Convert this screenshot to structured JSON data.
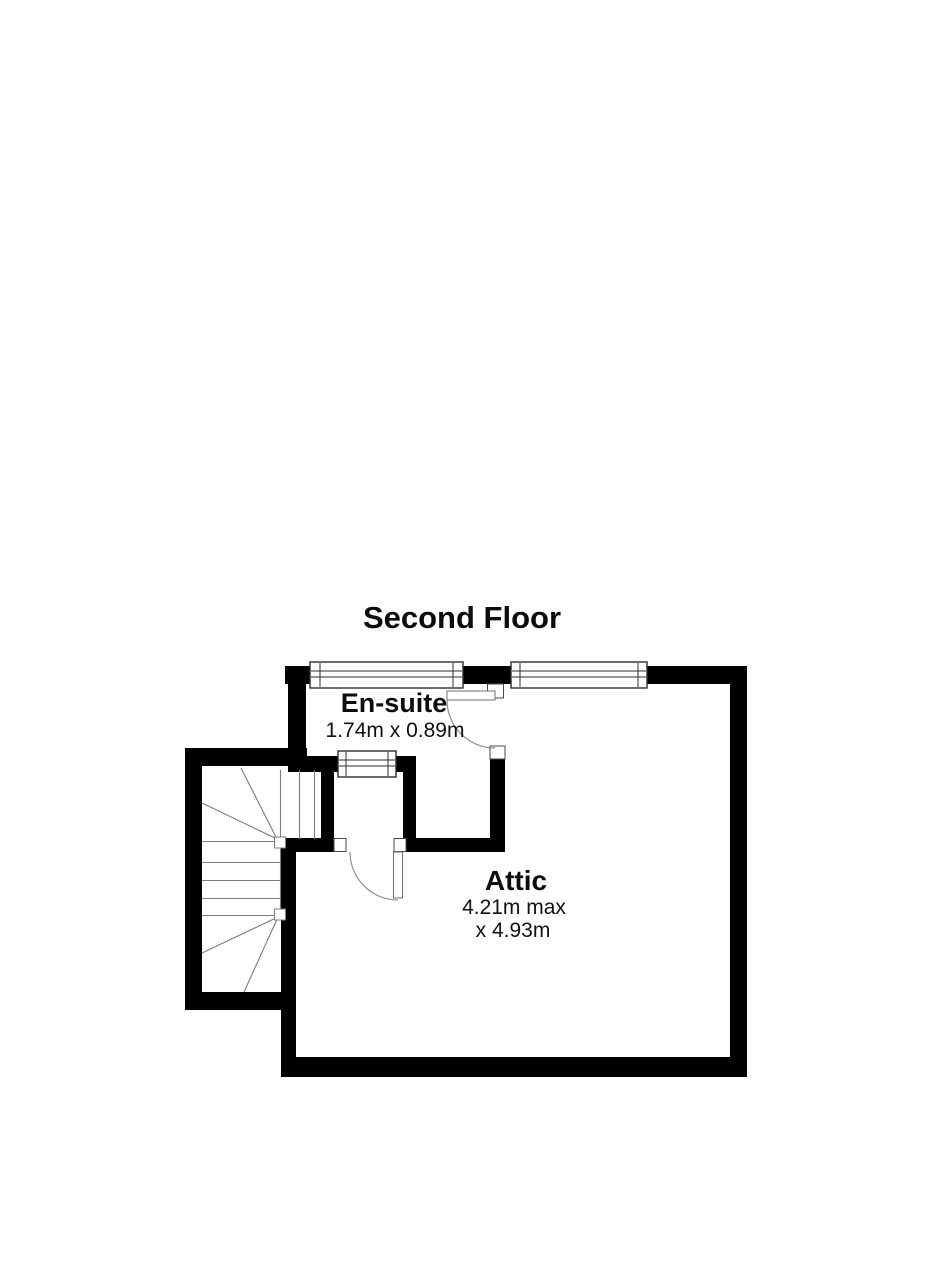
{
  "plan": {
    "title": "Second Floor",
    "rooms": [
      {
        "id": "ensuite",
        "name": "En-suite",
        "dimensions": "1.74m x 0.89m"
      },
      {
        "id": "attic",
        "name": "Attic",
        "dimensions_line1": "4.21m max",
        "dimensions_line2": "x 4.93m"
      }
    ],
    "features": {
      "windows_count": 3,
      "doors_count": 2,
      "staircase": "winder staircase"
    },
    "colors": {
      "background": "#ffffff",
      "wall": "#000000",
      "stair_line": "#7d7d7d",
      "door_arc": "#8f8f8f",
      "window_border": "#2e2e2e",
      "text": "#0c0c0c"
    }
  }
}
